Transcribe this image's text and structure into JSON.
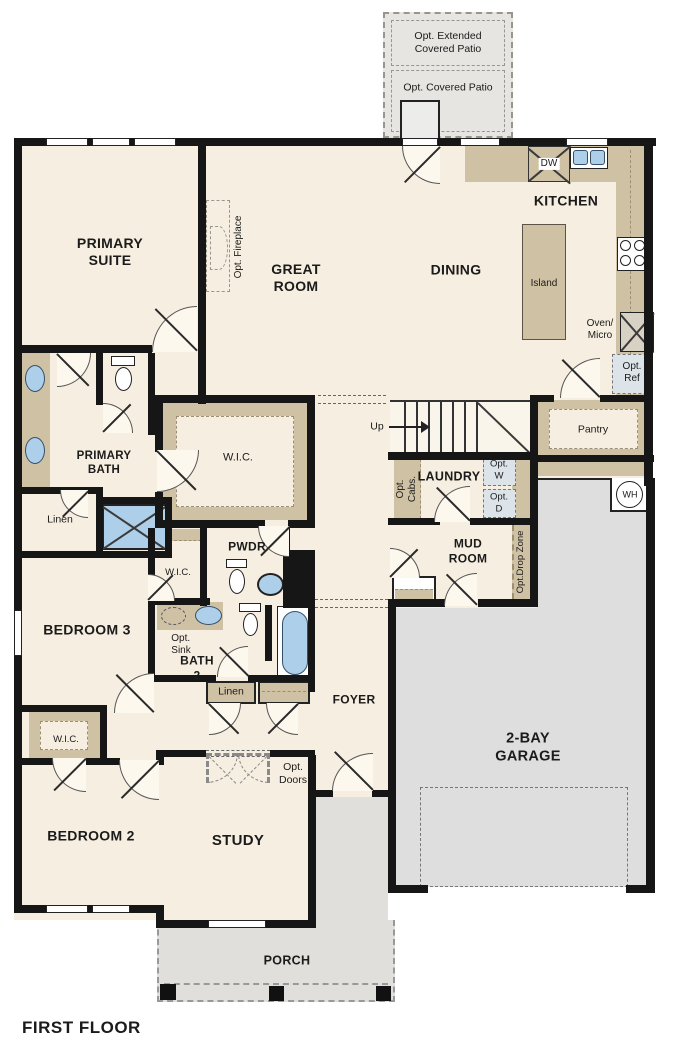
{
  "title": "FIRST FLOOR",
  "colors": {
    "wall": "#161616",
    "floor": "#f6eee0",
    "cabinet_tan": "#cfc1a3",
    "garage_gray": "#dedede",
    "fixture_blue": "#aecfe9",
    "opt_box": "#dce4ea"
  },
  "fp": {
    "patio": {
      "extended": "Opt. Extended\nCovered Patio",
      "covered": "Opt. Covered Patio"
    },
    "kitchen": {
      "name": "KITCHEN",
      "dw": "DW",
      "island": "Island",
      "oven_micro": "Oven/\nMicro",
      "opt_ref": "Opt.\nRef",
      "pantry": "Pantry"
    },
    "dining": {
      "name": "DINING"
    },
    "great_room": {
      "name": "GREAT\nROOM",
      "opt_fireplace": "Opt. Fireplace"
    },
    "primary_suite": {
      "name": "PRIMARY\nSUITE"
    },
    "primary_bath": {
      "name": "PRIMARY\nBATH",
      "linen": "Linen",
      "wic": "W.I.C."
    },
    "stairs": {
      "up": "Up"
    },
    "laundry": {
      "name": "LAUNDRY",
      "opt_cabs": "Opt.\nCabs.",
      "opt_w": "Opt.\nW",
      "opt_d": "Opt.\nD"
    },
    "mud_room": {
      "name": "MUD\nROOM",
      "drop_zone": "Opt.Drop Zone",
      "wh": "WH"
    },
    "pwdr": {
      "name": "PWDR"
    },
    "bath2": {
      "name": "BATH\n2",
      "opt_sink": "Opt.\nSink",
      "linen": "Linen",
      "wic": "W.I.C."
    },
    "bedroom3": {
      "name": "BEDROOM 3"
    },
    "bedroom2": {
      "name": "BEDROOM 2",
      "wic": "W.I.C."
    },
    "foyer": {
      "name": "FOYER"
    },
    "study": {
      "name": "STUDY",
      "opt_doors": "Opt.\nDoors"
    },
    "garage": {
      "name": "2-BAY\nGARAGE"
    },
    "porch": {
      "name": "PORCH"
    }
  }
}
